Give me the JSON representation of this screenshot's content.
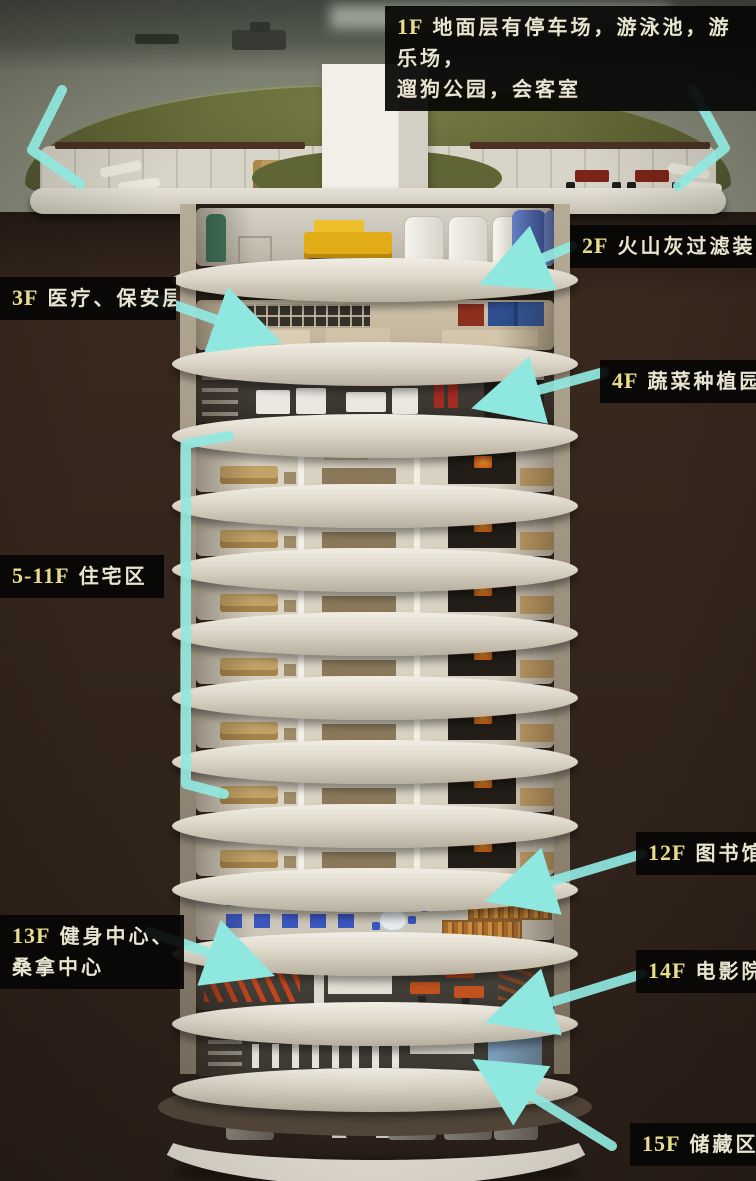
{
  "scene_title": "地下避难所楼层剖面图",
  "labels": {
    "f1": {
      "code": "1F",
      "lines": [
        "地面层有停车场，游泳池，游乐场，",
        "遛狗公园，会客室"
      ]
    },
    "f2": {
      "code": "2F",
      "lines": [
        "火山灰过滤装置"
      ]
    },
    "f3": {
      "code": "3F",
      "lines": [
        "医疗、保安层"
      ]
    },
    "f4": {
      "code": "4F",
      "lines": [
        "蔬菜种植园"
      ]
    },
    "f5_11": {
      "code": "5-11F",
      "lines": [
        "住宅区"
      ]
    },
    "f12": {
      "code": "12F",
      "lines": [
        "图书馆"
      ]
    },
    "f13": {
      "code": "13F",
      "lines": [
        "健身中心、",
        "桑拿中心"
      ]
    },
    "f14": {
      "code": "14F",
      "lines": [
        "电影院"
      ]
    },
    "f15": {
      "code": "15F",
      "lines": [
        "储藏区"
      ]
    }
  },
  "annotations": {
    "arrow_color": "#8fe8df",
    "arrows": [
      "entry-left-chevron",
      "entry-right-chevron",
      "arrow-2f",
      "arrow-3f",
      "arrow-4f",
      "bracket-5-11f",
      "arrow-12f",
      "arrow-13f",
      "arrow-14f",
      "arrow-15f"
    ]
  },
  "palette": {
    "label_background": "#070706",
    "label_floor_code": "#e9dd8d",
    "label_text": "#e9e4cf",
    "earth_brown": "#33251c",
    "roof_green": "#616635",
    "structure_white": "#e5e1d6",
    "tank_blue": "#3c5cb0",
    "generator_yellow": "#e2ac17"
  }
}
